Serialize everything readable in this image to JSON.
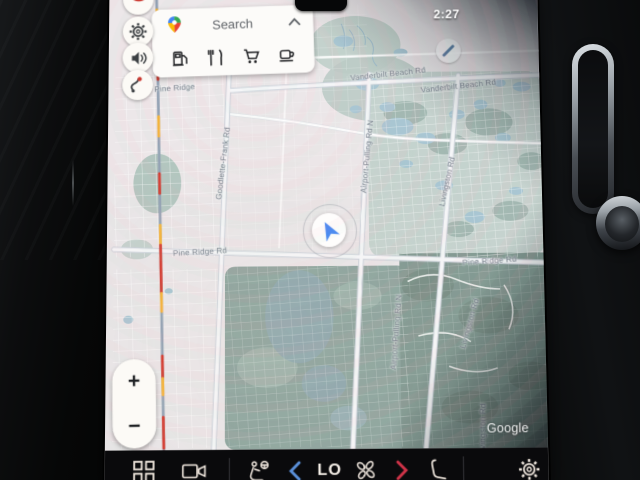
{
  "device": {
    "time": "2:27"
  },
  "search_card": {
    "label": "Search",
    "logo_icon": "google-maps-pin",
    "collapse_icon": "chevron-up",
    "categories": [
      {
        "name": "gas-stations",
        "icon": "fuel-pump-icon"
      },
      {
        "name": "restaurants",
        "icon": "restaurant-icon"
      },
      {
        "name": "groceries",
        "icon": "shopping-cart-icon"
      },
      {
        "name": "coffee",
        "icon": "coffee-cup-icon"
      }
    ]
  },
  "sidebar": {
    "buttons": [
      {
        "name": "notification",
        "icon": "red-pin-badge-icon"
      },
      {
        "name": "settings",
        "icon": "gear-icon"
      },
      {
        "name": "sound",
        "icon": "speaker-icon"
      },
      {
        "name": "alternate-routes",
        "icon": "route-icon"
      }
    ]
  },
  "map": {
    "provider_watermark": "Google",
    "location_indicator": "navigation-arrow",
    "labels": [
      {
        "text": "Pine Ridge",
        "x": 67,
        "y": 99,
        "rot": -4
      },
      {
        "text": "Goodlette-Frank Rd",
        "x": 116,
        "y": 176,
        "rot": -83
      },
      {
        "text": "Vanderbilt Beach Rd",
        "x": 283,
        "y": 86,
        "rot": -6
      },
      {
        "text": "Vanderbilt Beach Rd",
        "x": 354,
        "y": 99,
        "rot": -6
      },
      {
        "text": "Airport-Pulling Rd N",
        "x": 261,
        "y": 170,
        "rot": -84
      },
      {
        "text": "Pine Ridge Rd",
        "x": 93,
        "y": 265,
        "rot": -3
      },
      {
        "text": "Pine Ridge Rd",
        "x": 382,
        "y": 276,
        "rot": -4
      },
      {
        "text": "Livingston Rd",
        "x": 341,
        "y": 196,
        "rot": -77
      },
      {
        "text": "Airport-Pulling Rd N",
        "x": 288,
        "y": 346,
        "rot": -85
      },
      {
        "text": "Livingston Rd",
        "x": 361,
        "y": 338,
        "rot": -73
      },
      {
        "text": "Livingston Rd",
        "x": 372,
        "y": 442,
        "rot": -88
      }
    ],
    "traffic_colors": {
      "heavy": "#d23b30",
      "moderate": "#f3b33b"
    }
  },
  "zoom_controls": {
    "zoom_in": "+",
    "zoom_out": "−"
  },
  "bottom_bar": {
    "temperature": "LO",
    "items": [
      "app-launcher",
      "camera-view",
      "driver-seat-climate",
      "chevron-left",
      "temperature-display",
      "fan",
      "chevron-right",
      "passenger-seat-climate",
      "settings"
    ]
  },
  "colors": {
    "nav_arrow_blue": "#4285f4",
    "chevron_cold_blue": "#5a8fd8",
    "chevron_warm_red": "#cf3348",
    "maps_pin": {
      "blue": "#4285f4",
      "green": "#34a853",
      "yellow": "#fbbc04",
      "red": "#ea4335"
    }
  }
}
